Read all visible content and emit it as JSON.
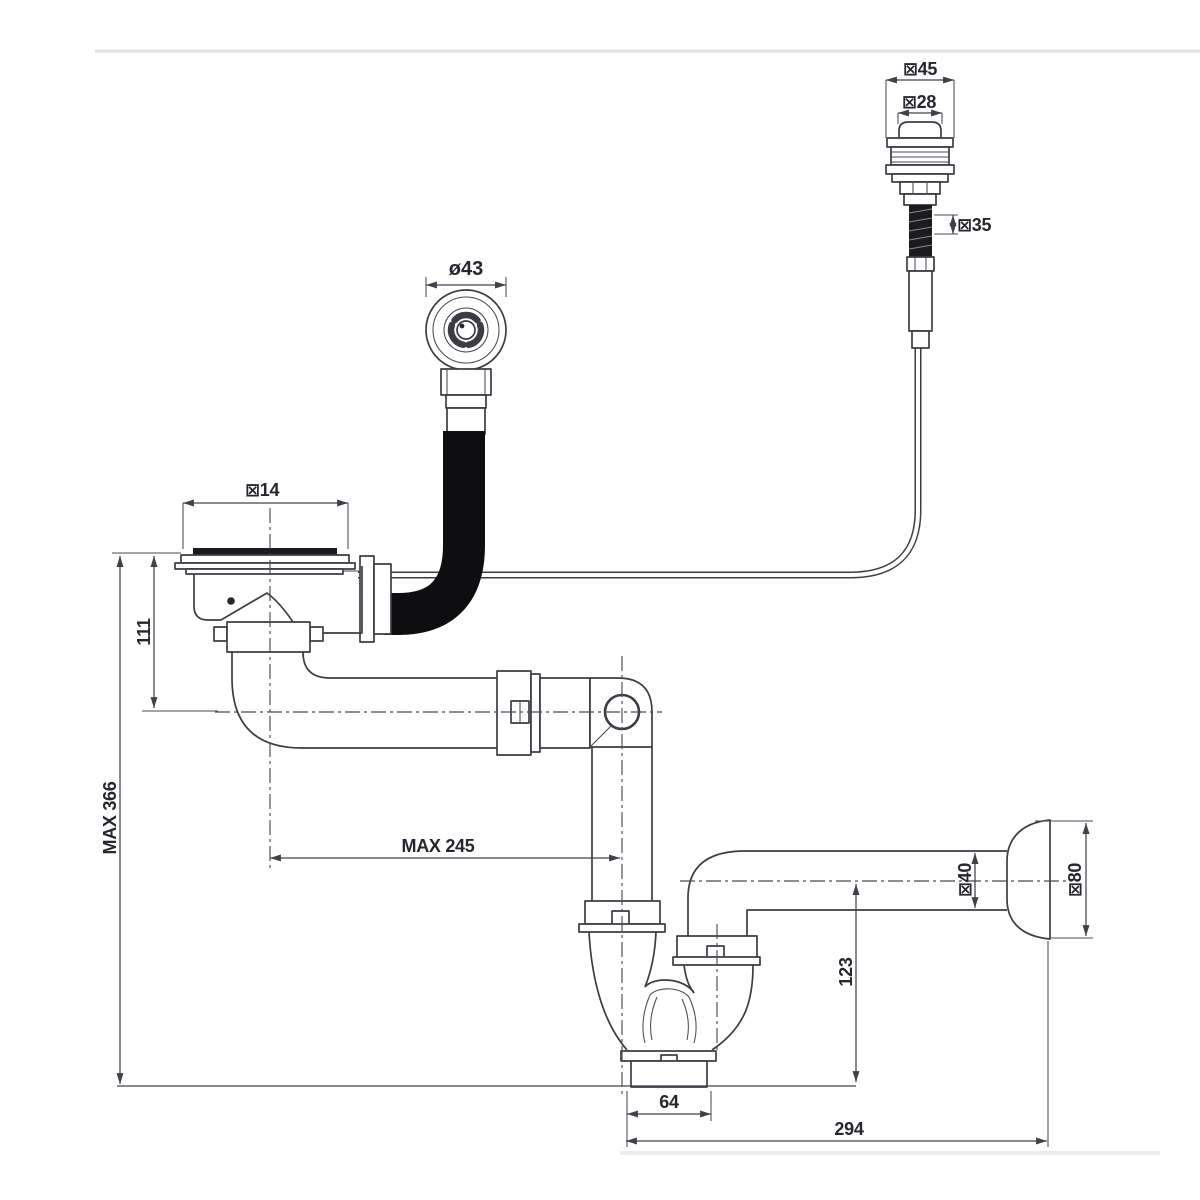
{
  "drawing": {
    "title": "sink-drain-with-overflow-and-pushbutton-waste-technical-drawing",
    "colors": {
      "background": "#ffffff",
      "line": "#3c3c44",
      "hose": "#0e0e10",
      "text": "#26262e"
    },
    "labels": {
      "button_flange_dia": "⊠45",
      "button_cap_dia": "⊠28",
      "button_thread_dia": "⊠35",
      "overflow_dia": "ø43",
      "strainer_dia": "⊠14",
      "strainer_depth": "111",
      "max_total_height": "MAX 366",
      "max_horizontal_reach": "MAX 245",
      "outlet_centre_drop": "123",
      "cleanout_width": "64",
      "trap_to_wall_length": "294",
      "outlet_pipe_dia": "⊠40",
      "wall_escutcheon_dia": "⊠80"
    }
  }
}
